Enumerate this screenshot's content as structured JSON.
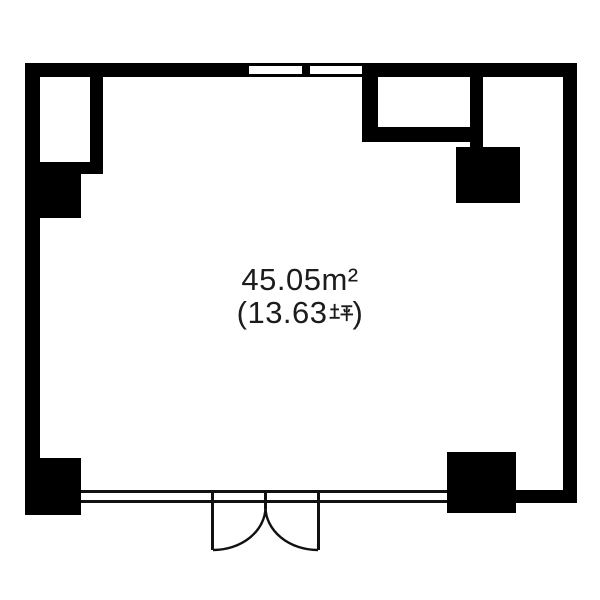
{
  "floor_plan": {
    "area_m2_label": "45.05m²",
    "area_tsubo_label": "(13.63坪)",
    "area_tsubo_prefix": "(13.63",
    "area_tsubo_unit": "坪",
    "area_tsubo_suffix": ")",
    "colors": {
      "wall": "#000000",
      "background": "#ffffff",
      "thin_line": "#111111"
    }
  }
}
